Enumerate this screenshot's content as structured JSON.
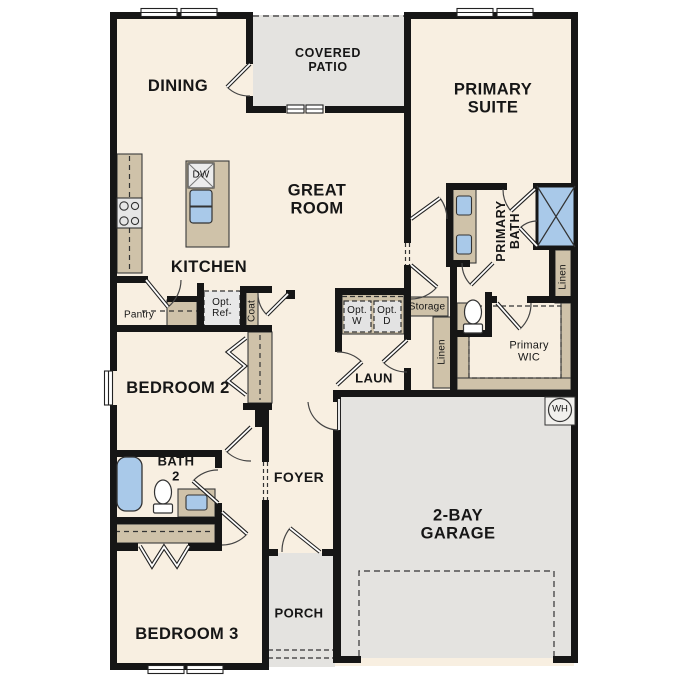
{
  "plan": {
    "colors": {
      "wall": "#161616",
      "floor": "#f8efe1",
      "outdoor": "#e4e3e0",
      "cabinet": "#cfc2a9",
      "fixture_blue": "#a9c9e9",
      "appliance": "#e8e8e8"
    },
    "rooms": {
      "dining": "DINING",
      "covered_patio": "COVERED\nPATIO",
      "primary_suite": "PRIMARY\nSUITE",
      "great_room": "GREAT\nROOM",
      "kitchen": "KITCHEN",
      "primary_bath": "PRIMARY\nBATH",
      "primary_wic": "Primary\nWIC",
      "bedroom2": "BEDROOM 2",
      "bedroom3": "BEDROOM 3",
      "bath2": "BATH\n2",
      "foyer": "FOYER",
      "laundry": "LAUN",
      "garage": "2-BAY\nGARAGE",
      "porch": "PORCH"
    },
    "closets": {
      "pantry": "Pantry",
      "coat": "Coat",
      "storage": "Storage",
      "linen_hall": "Linen",
      "linen_bath": "Linen"
    },
    "appliances": {
      "opt_ref": "Opt.\nRef-",
      "opt_washer": "Opt.\nW",
      "opt_dryer": "Opt.\nD",
      "dishwasher": "DW",
      "water_heater": "WH"
    }
  }
}
